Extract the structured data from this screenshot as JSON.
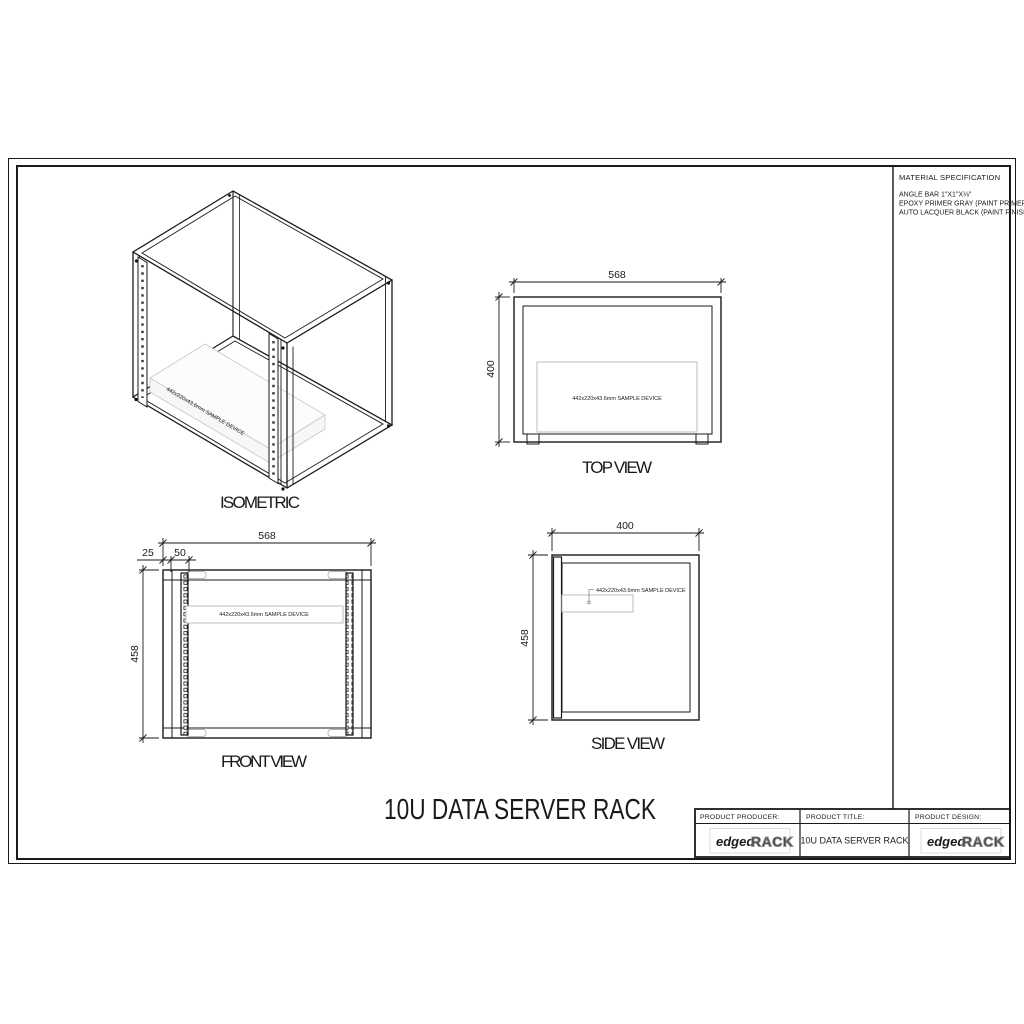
{
  "material_spec": {
    "title": "MATERIAL SPECIFICATION",
    "lines": [
      "ANGLE BAR 1\"X1\"X⅛\"",
      "EPOXY PRIMER GRAY (PAINT PRIMER)",
      "AUTO LACQUER BLACK (PAINT FINISH)"
    ]
  },
  "main_title": "10U DATA SERVER RACK",
  "views": {
    "isometric": {
      "label": "ISOMETRIC",
      "device_label": "442x220x43.6mm SAMPLE DEVICE"
    },
    "top": {
      "label": "TOP VIEW",
      "dim_width": "568",
      "dim_depth": "400",
      "device_label": "442x220x43.6mm SAMPLE DEVICE"
    },
    "front": {
      "label": "FRONT VIEW",
      "dim_width": "568",
      "dim_height": "458",
      "dim_edge_offset": "25",
      "dim_rail_offset": "50",
      "device_label": "442x220x43.6mm SAMPLE DEVICE"
    },
    "side": {
      "label": "SIDE VIEW",
      "dim_depth": "400",
      "dim_height": "458",
      "device_label": "442x220x43.6mm SAMPLE DEVICE"
    }
  },
  "title_block": {
    "producer_label": "PRODUCT PRODUCER:",
    "title_label": "PRODUCT TITLE:",
    "design_label": "PRODUCT DESIGN:",
    "product_title": "10U DATA SERVER RACK",
    "brand": {
      "edged": "edged",
      "rack": "RACK"
    }
  },
  "colors": {
    "line": "#1a1a1a",
    "light_line": "#bdbdbd",
    "logo_gray": "#8f8f8f"
  }
}
